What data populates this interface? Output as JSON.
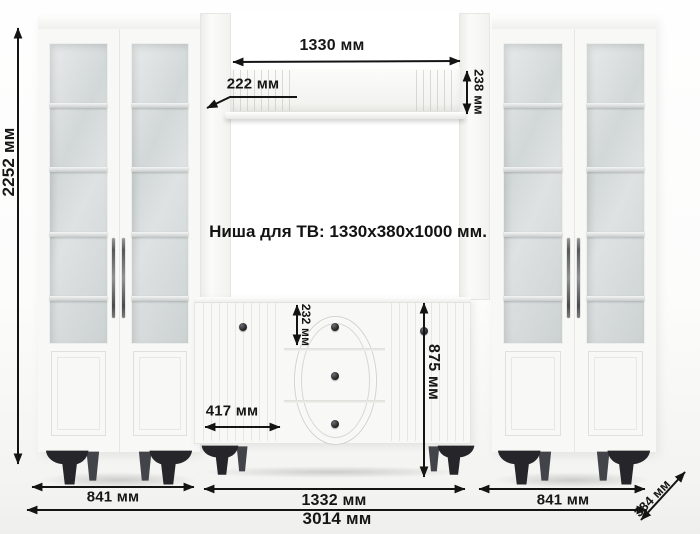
{
  "niche": {
    "label": "Ниша для ТВ: 1330x380x1000 мм."
  },
  "dimensions": {
    "total_height": "2252 мм",
    "shelf_length": "1330 мм",
    "shelf_depth": "222 мм",
    "shelf_end_height": "238 мм",
    "top_drawer_height": "232 мм",
    "dresser_height": "875 мм",
    "dresser_door_width": "417 мм",
    "left_cabinet_width": "841 мм",
    "center_section_width": "1332 мм",
    "right_cabinet_width": "841 мм",
    "total_width": "3014 мм",
    "depth": "384 мм"
  },
  "colors": {
    "annotation": "#141414",
    "furniture": "#f8f8f6",
    "glass": "#d6dada",
    "legs": "#26262a",
    "background": "#fcfcfb"
  }
}
